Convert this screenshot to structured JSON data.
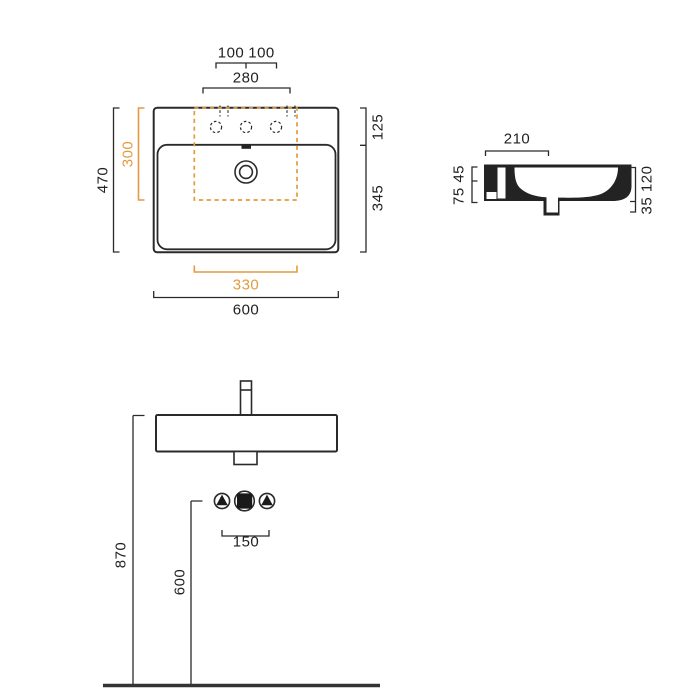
{
  "drawing": {
    "type": "washbasin-technical-drawing",
    "line_color": "#2a2a2a",
    "accent_color": "#E39A40",
    "plan_view": {
      "tap_hole_left_offset": "100",
      "tap_hole_right_offset": "100",
      "tap_hole_span": "280",
      "overall_depth": "470",
      "cutout_depth": "300",
      "rim_depth": "125",
      "basin_depth": "345",
      "cutout_width": "330",
      "overall_width": "600"
    },
    "side_view": {
      "ledge_width": "210",
      "rear_heights": "75 45",
      "front_heights": "35 120"
    },
    "front_view": {
      "rim_height_from_floor": "870",
      "connection_height_from_floor": "600",
      "connection_spacing": "150"
    },
    "symbols": {
      "water_connection": "triangle-in-circle",
      "drain_connection": "square-in-circle"
    }
  }
}
